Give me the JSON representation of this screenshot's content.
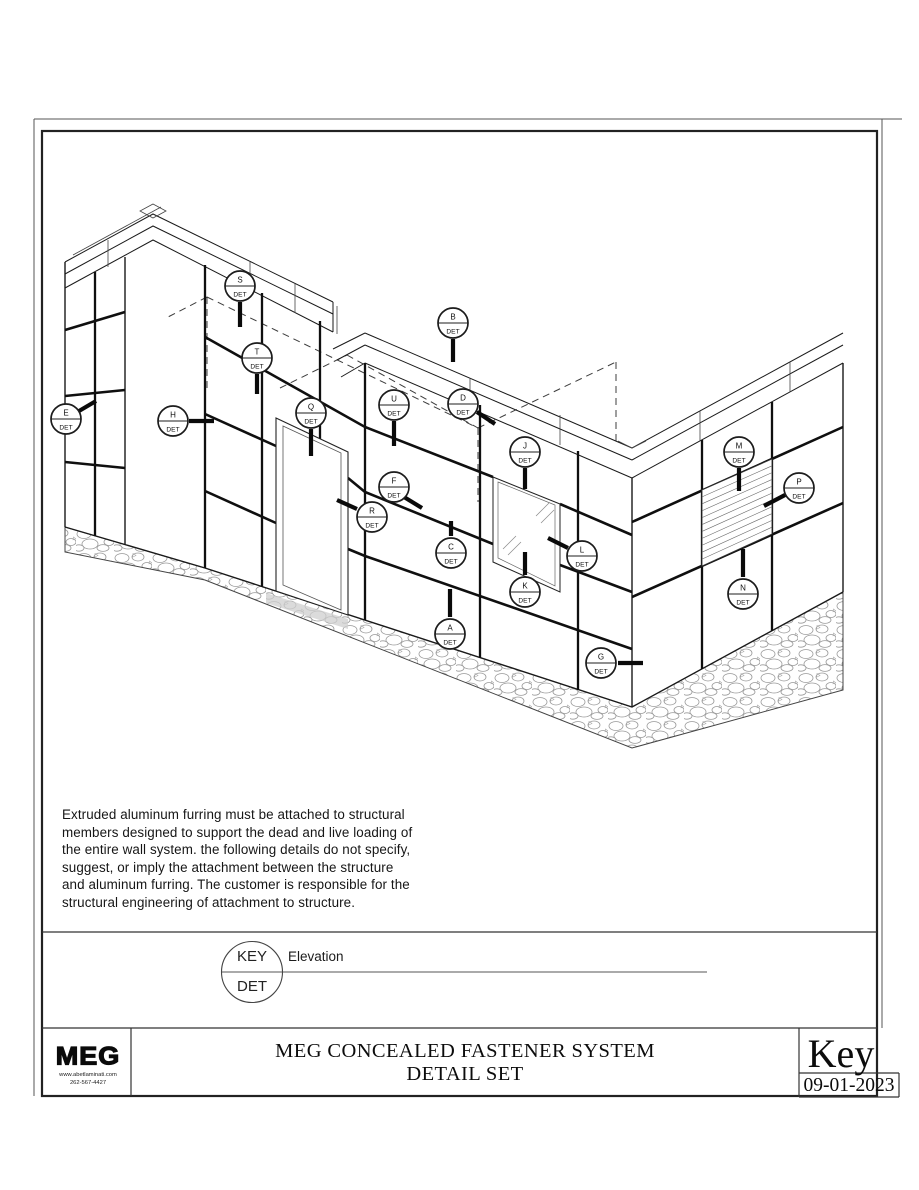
{
  "sheet": {
    "background": "#ffffff",
    "line_color": "#1a1a1a"
  },
  "notes": {
    "text": "Extruded aluminum furring must be attached to structural\nmembers designed to support the dead and live loading of\nthe entire wall system. the following details do not specify,\nsuggest, or imply the attachment between the structure\nand aluminum furring. The customer is responsible for the\nstructural engineering of attachment to structure."
  },
  "key_legend": {
    "top_label": "KEY",
    "bottom_label": "DET",
    "line_label": "Elevation"
  },
  "title_block": {
    "logo_text": "MEG",
    "logo_website": "www.abetlaminati.com",
    "logo_phone": "262-567-4427",
    "title_line1": "MEG CONCEALED FASTENER SYSTEM",
    "title_line2": "DETAIL SET",
    "sheet_name": "Key",
    "date": "09-01-2023"
  },
  "drawing": {
    "det_label": "DET",
    "callouts": [
      {
        "letter": "S",
        "x": 240,
        "y": 286,
        "tick": [
          240,
          302,
          240,
          327
        ]
      },
      {
        "letter": "T",
        "x": 257,
        "y": 358,
        "tick": [
          257,
          374,
          257,
          394
        ]
      },
      {
        "letter": "B",
        "x": 453,
        "y": 323,
        "tick": [
          453,
          339,
          453,
          362
        ]
      },
      {
        "letter": "E",
        "x": 66,
        "y": 419,
        "tick": [
          79,
          411,
          96,
          401
        ]
      },
      {
        "letter": "H",
        "x": 173,
        "y": 421,
        "tick": [
          189,
          421,
          214,
          421
        ]
      },
      {
        "letter": "Q",
        "x": 311,
        "y": 413,
        "tick": [
          311,
          429,
          311,
          456
        ]
      },
      {
        "letter": "U",
        "x": 394,
        "y": 405,
        "tick": [
          394,
          421,
          394,
          446
        ]
      },
      {
        "letter": "D",
        "x": 463,
        "y": 404,
        "tick": [
          477,
          412,
          495,
          424
        ]
      },
      {
        "letter": "J",
        "x": 525,
        "y": 452,
        "tick": [
          525,
          468,
          525,
          489
        ]
      },
      {
        "letter": "M",
        "x": 739,
        "y": 452,
        "tick": [
          739,
          468,
          739,
          491
        ]
      },
      {
        "letter": "P",
        "x": 799,
        "y": 488,
        "tick": [
          785,
          495,
          764,
          506
        ]
      },
      {
        "letter": "F",
        "x": 394,
        "y": 487,
        "tick": [
          404,
          497,
          422,
          508
        ]
      },
      {
        "letter": "R",
        "x": 372,
        "y": 517,
        "tick": [
          357,
          509,
          337,
          500
        ]
      },
      {
        "letter": "C",
        "x": 451,
        "y": 553,
        "tick": [
          451,
          536,
          451,
          521
        ]
      },
      {
        "letter": "L",
        "x": 582,
        "y": 556,
        "tick": [
          568,
          548,
          548,
          538
        ]
      },
      {
        "letter": "K",
        "x": 525,
        "y": 592,
        "tick": [
          525,
          575,
          525,
          578
        ],
        "tick2": [
          525,
          575,
          525,
          552
        ]
      },
      {
        "letter": "N",
        "x": 743,
        "y": 594,
        "tick": [
          743,
          577,
          743,
          549
        ]
      },
      {
        "letter": "A",
        "x": 450,
        "y": 634,
        "tick": [
          450,
          617,
          450,
          589
        ]
      },
      {
        "letter": "G",
        "x": 601,
        "y": 663,
        "tick": [
          618,
          663,
          643,
          663
        ]
      }
    ],
    "louver": {
      "x1": 702,
      "x2": 772,
      "y_top": [
        490,
        459
      ],
      "y_bot": [
        566,
        534
      ],
      "slats": 10
    }
  }
}
